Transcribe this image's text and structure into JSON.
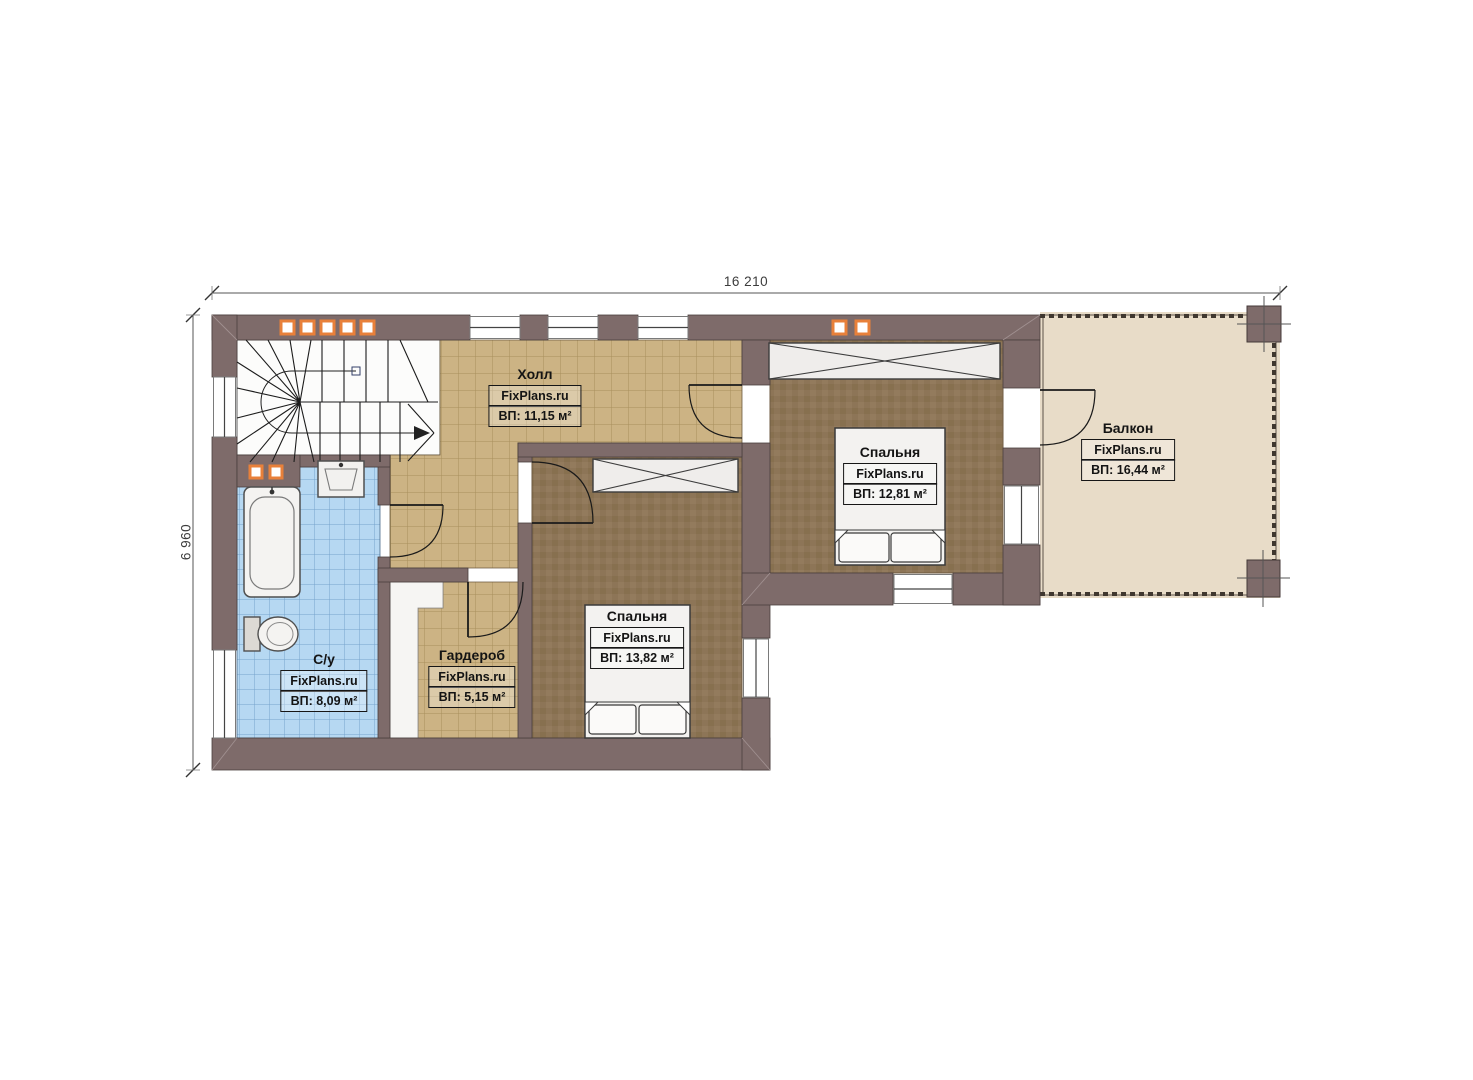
{
  "plan": {
    "dimensions": {
      "total_width": "16 210",
      "total_height": "6 960"
    },
    "rooms": {
      "hall": {
        "name": "Холл",
        "brand": "FixPlans.ru",
        "area": "ВП: 11,15 м²"
      },
      "bedroom_right": {
        "name": "Спальня",
        "brand": "FixPlans.ru",
        "area": "ВП: 12,81 м²"
      },
      "balcony": {
        "name": "Балкон",
        "brand": "FixPlans.ru",
        "area": "ВП: 16,44 м²"
      },
      "bedroom_center": {
        "name": "Спальня",
        "brand": "FixPlans.ru",
        "area": "ВП: 13,82 м²"
      },
      "wardrobe": {
        "name": "Гардероб",
        "brand": "FixPlans.ru",
        "area": "ВП: 5,15 м²"
      },
      "bathroom": {
        "name": "С/у",
        "brand": "FixPlans.ru",
        "area": "ВП: 8,09 м²"
      }
    },
    "colors": {
      "wall": "#7e6b6a",
      "floor_tile_tan": "#ccb384",
      "floor_tile_blue": "#b6d8f2",
      "carpet_brown": "#8d7557",
      "balcony_floor": "#e8dcc8",
      "vent_accent_orange": "#e8803a",
      "line_dark": "#1a1a1a"
    }
  }
}
